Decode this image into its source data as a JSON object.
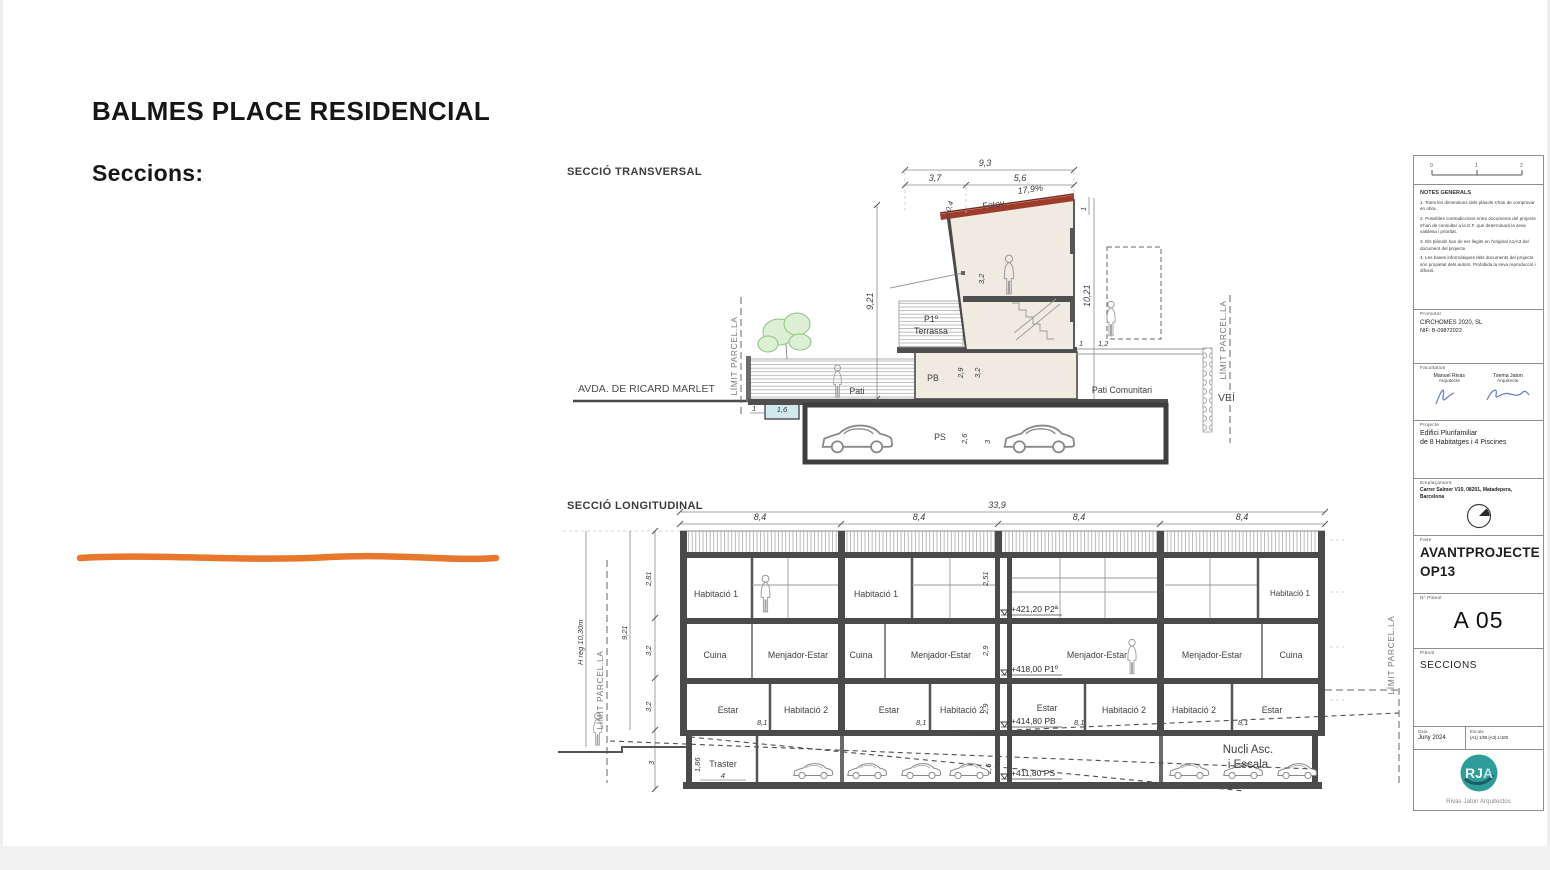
{
  "slide": {
    "title": "BALMES PLACE RESIDENCIAL",
    "subtitle": "Seccions:",
    "accent_color": "#E8772E"
  },
  "labels": {
    "limit": "LÍMIT  PARCEL.LA"
  },
  "trv": {
    "title": "SECCIÓ TRANSVERSAL",
    "street": "AVDA. DE RICARD MARLET",
    "vei": "VEÍ",
    "pati": "Pati",
    "pati_comunitari": "Pati Comunitari",
    "p1": "P1º",
    "terrassa": "Terrassa",
    "pb": "PB",
    "ps": "PS",
    "fotov": "Fotov.",
    "slope": "17,9%",
    "dims": {
      "w_total": "9,3",
      "w_left": "3,7",
      "w_right": "5,6",
      "roof_edge": "0,4",
      "roof_h": "1",
      "h_left": "9,21",
      "h_right": "10,21",
      "h_p2": "3,2",
      "h_pb_clear": "2,9",
      "h_pb": "3,2",
      "h_ps_clear": "2,6",
      "h_ps": "3",
      "w_vei_1": "1",
      "w_vei_12": "1,2",
      "pool_w": "1,6",
      "pool_off": "1"
    }
  },
  "lng": {
    "title": "SECCIÓ LONGITUDINAL",
    "dims": {
      "total": "33,9",
      "bays": [
        "8,4",
        "8,4",
        "8,4",
        "8,4"
      ],
      "h_p2": "2,81",
      "h_p1": "3,2",
      "h_pb": "3,2",
      "h_ps": "3",
      "i_p2": "2,51",
      "i_p1": "2,9",
      "i_pb": "2,9",
      "i_ps": "2,6",
      "h_total": "9,21",
      "h_reg": "H reg 10,30m",
      "room_w": "8,1",
      "traster_w": "4",
      "traster_h": "1,86"
    },
    "levels": {
      "p2": "+421,20 P2ª",
      "p1": "+418,00 P1º",
      "pb": "+414,80 PB",
      "ps": "+411,80 PS"
    },
    "rooms": {
      "hab1": "Habitació 1",
      "hab2": "Habitació 2",
      "cuina": "Cuina",
      "menjador": "Menjador-Estar",
      "estar": "Estar",
      "traster": "Traster",
      "nucli1": "Nucli Asc.",
      "nucli2": "i Escala"
    }
  },
  "titleblock": {
    "scale_ticks": [
      "0",
      "1",
      "2"
    ],
    "notes_title": "NOTES GENERALS",
    "notes": [
      "1. Totes les dimensions dels plànols s'han de comprovar en obra.",
      "2. Possibles contradiccions entre documents del projecte s'han de consultar a la D.F. que determinarà la seva validesa i prioritat.",
      "3. Els plànols han de ser llegits en l'original A1/A3 del document del projecte.",
      "4. Les bases informàtiques dels documents del projecte són propietat dels autors. Prohibida la seva reproducció i difusió."
    ],
    "promotor_label": "Promotor",
    "promotor_name": "CIRCHOMES 2020, SL",
    "promotor_nif": "NIF: B-09872022",
    "facultatius_label": "Facultatius",
    "facultatiu1_name": "Manuel Rivas",
    "facultatiu1_role": "Arquitecte",
    "facultatiu2_name": "Txema Jaton",
    "facultatiu2_role": "Arquitecte",
    "projecte_label": "Projecte",
    "projecte_line1": "Edifici Plurifamiliar",
    "projecte_line2": "de 8 Habitatges i 4 Piscines",
    "emplacament_label": "Emplaçament",
    "emplacament_line1": "Carrer Salmer V10, 08201, Matadepera,",
    "emplacament_line2": "Barcelona",
    "fase_label": "Fase",
    "fase_line1": "AVANTPROJECTE",
    "fase_line2": "OP13",
    "num_label": "Nº Plànol",
    "num": "A 05",
    "planol_label": "Plànol",
    "planol": "SECCIONS",
    "data_label": "Data",
    "data": "Juny 2024",
    "escala_label": "Escala",
    "escala": "(A1) 1/50   (A3) 1/100",
    "logo_text": "RJA",
    "logo_caption": "Rivas Jaton Arquitectos"
  }
}
